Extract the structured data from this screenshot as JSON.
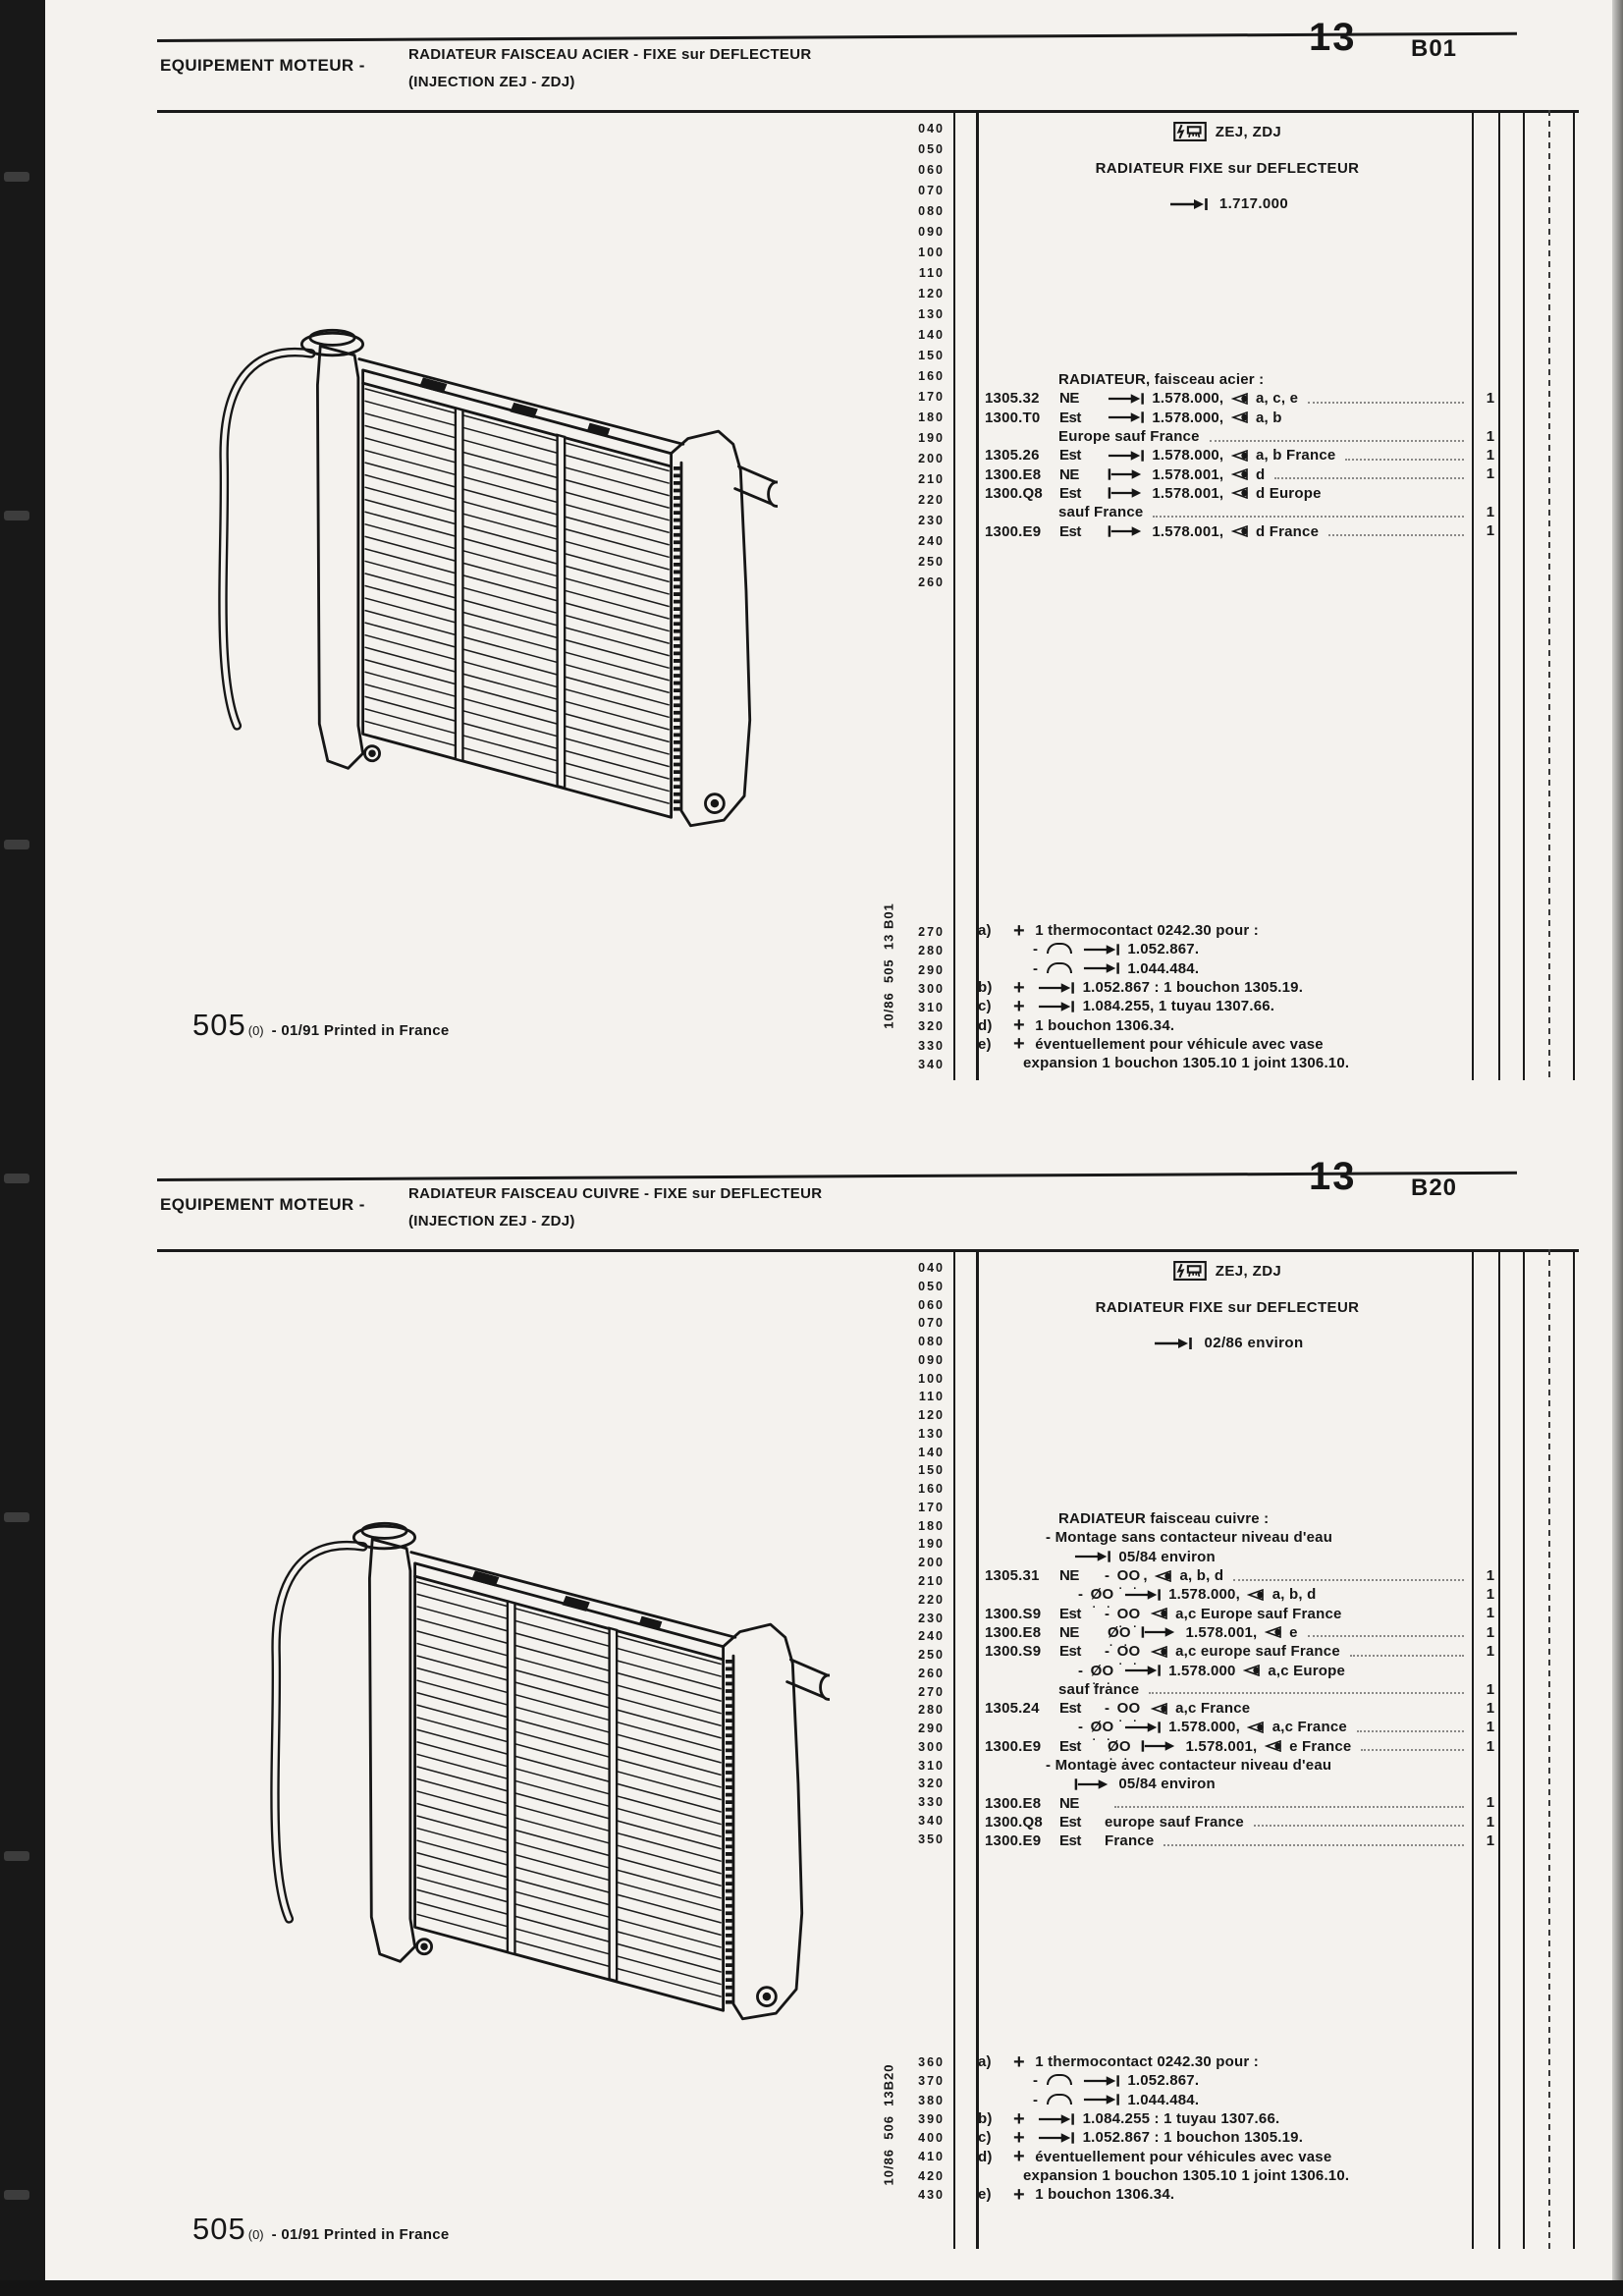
{
  "accent_colors": {
    "ink": "#161616",
    "paper": "#f4f2ee"
  },
  "sections": [
    {
      "header": {
        "eyebrow": "EQUIPEMENT MOTEUR -",
        "title_line1": "RADIATEUR FAISCEAU ACIER - FIXE sur DEFLECTEUR",
        "title_line2": "(INJECTION ZEJ - ZDJ)",
        "plate_number": "13",
        "plate_code": "B01"
      },
      "panel": {
        "icon": "injection-symbol-icon",
        "models": "ZEJ, ZDJ",
        "title": "RADIATEUR FIXE sur DEFLECTEUR",
        "range": "1.717.000"
      },
      "margin_nums": [
        "040",
        "050",
        "060",
        "070",
        "080",
        "090",
        "100",
        "110",
        "120",
        "130",
        "140",
        "150",
        "160",
        "170",
        "180",
        "190",
        "200",
        "210",
        "220",
        "230",
        "240",
        "250",
        "260"
      ],
      "note_margin_nums": [
        "270",
        "280",
        "290",
        "300",
        "310",
        "320",
        "330",
        "340"
      ],
      "rows": [
        {
          "ind": 75,
          "desc": "RADIATEUR, faisceau acier :"
        },
        {
          "ref": "1305.32",
          "sym": "NE",
          "desc": "{->|} 1.578.000, {eye} a, c, e",
          "dots": true,
          "qty": "1"
        },
        {
          "ref": "1300.T0",
          "sym": "Est",
          "desc": "{->|} 1.578.000, {eye} a, b"
        },
        {
          "ind": 75,
          "desc": "Europe sauf France",
          "dots": true,
          "qty": "1"
        },
        {
          "ref": "1305.26",
          "sym": "Est",
          "desc": "{->|} 1.578.000, {eye} a, b France",
          "dots": true,
          "qty": "1"
        },
        {
          "ref": "1300.E8",
          "sym": "NE",
          "desc": "{|->} 1.578.001, {eye} d",
          "dots": true,
          "qty": "1"
        },
        {
          "ref": "1300.Q8",
          "sym": "Est",
          "desc": "{|->} 1.578.001, {eye} d Europe"
        },
        {
          "ind": 75,
          "desc": "sauf France",
          "dots": true,
          "qty": "1"
        },
        {
          "ref": "1300.E9",
          "sym": "Est",
          "desc": "{|->} 1.578.001, {eye} d France",
          "dots": true,
          "qty": "1"
        }
      ],
      "notes": [
        {
          "label": "a)",
          "desc": "{+} 1 thermocontact 0242.30 pour :"
        },
        {
          "ind": 22,
          "desc": "- {arc} {->|} 1.052.867."
        },
        {
          "ind": 22,
          "desc": "- {arc} {->|} 1.044.484."
        },
        {
          "label": "b)",
          "desc": "{+} {->|} 1.052.867 : 1 bouchon 1305.19."
        },
        {
          "label": "c)",
          "desc": "{+} {->|} 1.084.255, 1 tuyau 1307.66."
        },
        {
          "label": "d)",
          "desc": "{+} 1 bouchon 1306.34."
        },
        {
          "label": "e)",
          "desc": "{+} éventuellement pour véhicule avec vase"
        },
        {
          "ind": 12,
          "desc": "expansion 1 bouchon 1305.10 1 joint 1306.10."
        }
      ],
      "stamp": "10/86  505  13 B01",
      "footer": {
        "model": "505",
        "sub": "(0)",
        "text": "- 01/91 Printed in France"
      }
    },
    {
      "header": {
        "eyebrow": "EQUIPEMENT MOTEUR -",
        "title_line1": "RADIATEUR FAISCEAU CUIVRE - FIXE sur DEFLECTEUR",
        "title_line2": "(INJECTION ZEJ - ZDJ)",
        "plate_number": "13",
        "plate_code": "B20"
      },
      "panel": {
        "icon": "injection-symbol-icon",
        "models": "ZEJ, ZDJ",
        "title": "RADIATEUR FIXE sur DEFLECTEUR",
        "range": "02/86 environ"
      },
      "margin_nums": [
        "040",
        "050",
        "060",
        "070",
        "080",
        "090",
        "100",
        "110",
        "120",
        "130",
        "140",
        "150",
        "160",
        "170",
        "180",
        "190",
        "200",
        "210",
        "220",
        "230",
        "240",
        "250",
        "260",
        "270",
        "280",
        "290",
        "300",
        "310",
        "320",
        "330",
        "340",
        "350"
      ],
      "note_margin_nums": [
        "360",
        "370",
        "380",
        "390",
        "400",
        "410",
        "420",
        "430"
      ],
      "rows": [
        {
          "ind": 75,
          "desc": "RADIATEUR faisceau cuivre :"
        },
        {
          "ind": 62,
          "desc": "- Montage sans contacteur niveau d'eau"
        },
        {
          "ind": 88,
          "desc": "{->|} 05/84 environ"
        },
        {
          "ref": "1305.31",
          "sym": "NE",
          "desc": "- {OO}, {eye} a, b, d",
          "dots": true,
          "qty": "1"
        },
        {
          "ind": 95,
          "desc": "- {OO/} {->|} 1.578.000, {eye} a, b, d",
          "qty": "1"
        },
        {
          "ref": "1300.S9",
          "sym": "Est",
          "desc": "- {OO} {eye} a,c Europe sauf France",
          "qty": "1"
        },
        {
          "ref": "1300.E8",
          "sym": "NE",
          "desc": "{OO/} {|->} 1.578.001, {eye} e",
          "dots": true,
          "qty": "1"
        },
        {
          "ref": "1300.S9",
          "sym": "Est",
          "desc": "- {OO} {eye} a,c europe sauf France",
          "dots": true,
          "qty": "1"
        },
        {
          "ind": 95,
          "desc": "- {OO/} {->|} 1.578.000 {eye} a,c Europe"
        },
        {
          "ind": 75,
          "desc": "sauf france",
          "dots": true,
          "qty": "1"
        },
        {
          "ref": "1305.24",
          "sym": "Est",
          "desc": "- {OO} {eye} a,c France",
          "qty": "1"
        },
        {
          "ind": 95,
          "desc": "- {OO/} {->|} 1.578.000, {eye} a,c France",
          "dots": true,
          "qty": "1"
        },
        {
          "ref": "1300.E9",
          "sym": "Est",
          "desc": "{OO/} {|->} 1.578.001, {eye} e France",
          "dots": true,
          "qty": "1"
        },
        {
          "ind": 62,
          "desc": "- Montage avec contacteur niveau d'eau"
        },
        {
          "ind": 88,
          "desc": "{|->} 05/84 environ"
        },
        {
          "ref": "1300.E8",
          "sym": "NE",
          "desc": "",
          "dots": true,
          "qty": "1"
        },
        {
          "ref": "1300.Q8",
          "sym": "Est",
          "desc": "europe sauf France",
          "dots": true,
          "qty": "1"
        },
        {
          "ref": "1300.E9",
          "sym": "Est",
          "desc": "France",
          "dots": true,
          "qty": "1"
        }
      ],
      "notes": [
        {
          "label": "a)",
          "desc": "{+} 1 thermocontact 0242.30 pour :"
        },
        {
          "ind": 22,
          "desc": "- {arc} {->|} 1.052.867."
        },
        {
          "ind": 22,
          "desc": "- {arc} {->|} 1.044.484."
        },
        {
          "label": "b)",
          "desc": "{+} {->|} 1.084.255 : 1 tuyau 1307.66."
        },
        {
          "label": "c)",
          "desc": "{+} {->|} 1.052.867 : 1 bouchon 1305.19."
        },
        {
          "label": "d)",
          "desc": "{+} éventuellement pour véhicules avec vase"
        },
        {
          "ind": 12,
          "desc": "expansion 1 bouchon 1305.10 1 joint 1306.10."
        },
        {
          "label": "e)",
          "desc": "{+} 1 bouchon 1306.34."
        }
      ],
      "stamp": "10/86  506  13B20",
      "footer": {
        "model": "505",
        "sub": "(0)",
        "text": "- 01/91 Printed in France"
      }
    }
  ]
}
